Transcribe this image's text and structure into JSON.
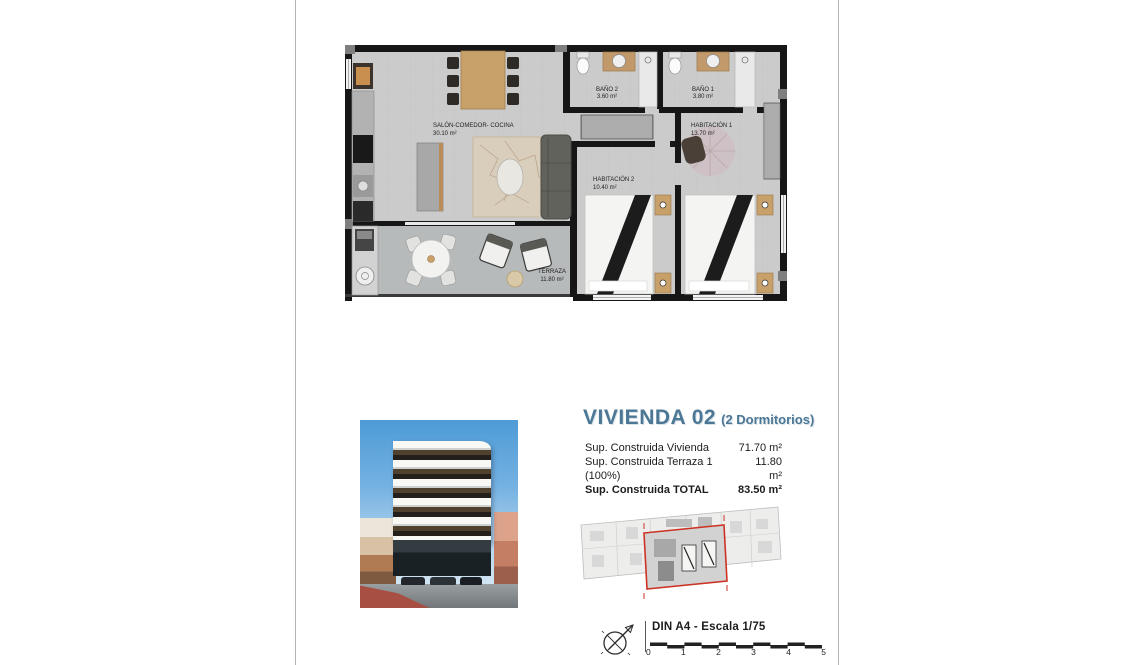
{
  "document": {
    "floor_plan": {
      "rooms": [
        {
          "name": "SALÓN-COMEDOR- COCINA",
          "area": "30.10 m²"
        },
        {
          "name": "BAÑO 2",
          "area": "3.60 m²"
        },
        {
          "name": "BAÑO 1",
          "area": "3.80 m²"
        },
        {
          "name": "HABITACIÓN 1",
          "area": "13.70 m²"
        },
        {
          "name": "HABITACIÓN 2",
          "area": "10.40 m²"
        },
        {
          "name": "TERRAZA",
          "area": "11.80 m²"
        }
      ]
    },
    "unit_info": {
      "title": "VIVIENDA 02",
      "subtitle": "(2 Dormitorios)",
      "specs": [
        {
          "label": "Sup. Construida Vivienda",
          "value": "71.70 m²"
        },
        {
          "label": "Sup. Construida Terraza 1 (100%)",
          "value": "11.80 m²"
        },
        {
          "label": "Sup. Construida TOTAL",
          "value": "83.50 m²"
        }
      ]
    },
    "footer": {
      "scale_label": "DIN A4 - Escala 1/75",
      "scale_ticks": [
        "0",
        "1",
        "2",
        "3",
        "4",
        "5"
      ]
    },
    "colors": {
      "title_blue": "#4c7795",
      "highlight_red": "#cc3324",
      "wall_black": "#161616",
      "floor_gray": "#cbcbcb",
      "terrace_gray": "#b7baba"
    }
  }
}
